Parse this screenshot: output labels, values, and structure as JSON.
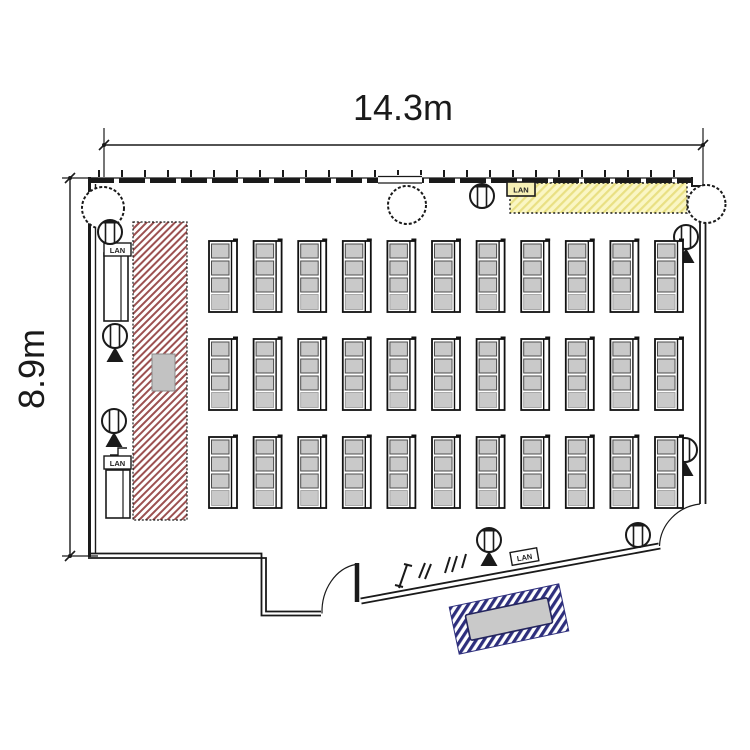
{
  "dimensions": {
    "width_label": "14.3m",
    "height_label": "8.9m"
  },
  "labels": {
    "lan": "LAN"
  },
  "layout": {
    "desk_grid": {
      "columns": 11,
      "rows": 3,
      "chairs_per_desk": 3
    },
    "structural_columns_count": 3,
    "ceiling_speakers_count": 8,
    "lan_ports_count": 4
  },
  "colors": {
    "wall": "#1a1a1a",
    "stage_hatch": "#9c5151",
    "counter_fill": "#faf6c4",
    "counter_stripe": "#e9e083",
    "desk_fill": "#c9c9c9",
    "chair_stroke": "#4d4d4d",
    "mat_stripe": "#2e2f7d",
    "podium_fill": "#c2c2c2"
  }
}
